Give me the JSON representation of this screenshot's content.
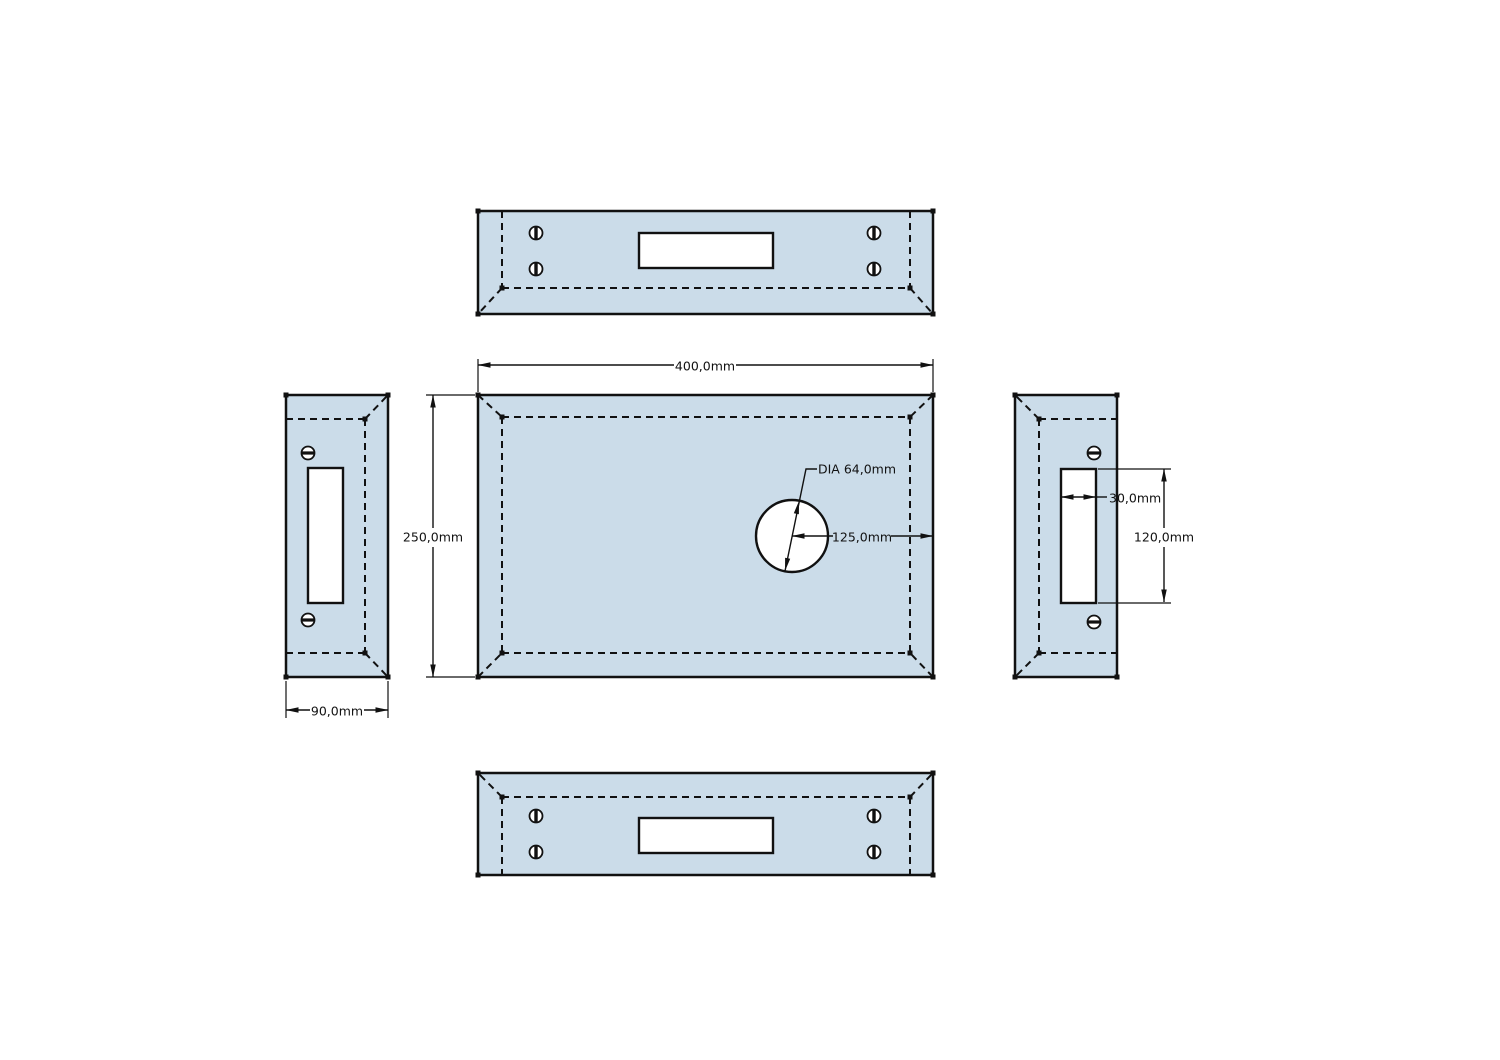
{
  "drawing": {
    "dimensions": {
      "width": "400,0mm",
      "height": "250,0mm",
      "depth": "90,0mm",
      "hole_diameter": "DIA 64,0mm",
      "hole_center_offset": "125,0mm",
      "slot_width": "30,0mm",
      "slot_height": "120,0mm"
    },
    "colors": {
      "panel_fill": "#cbdce9",
      "line": "#111111",
      "background": "#ffffff"
    }
  }
}
